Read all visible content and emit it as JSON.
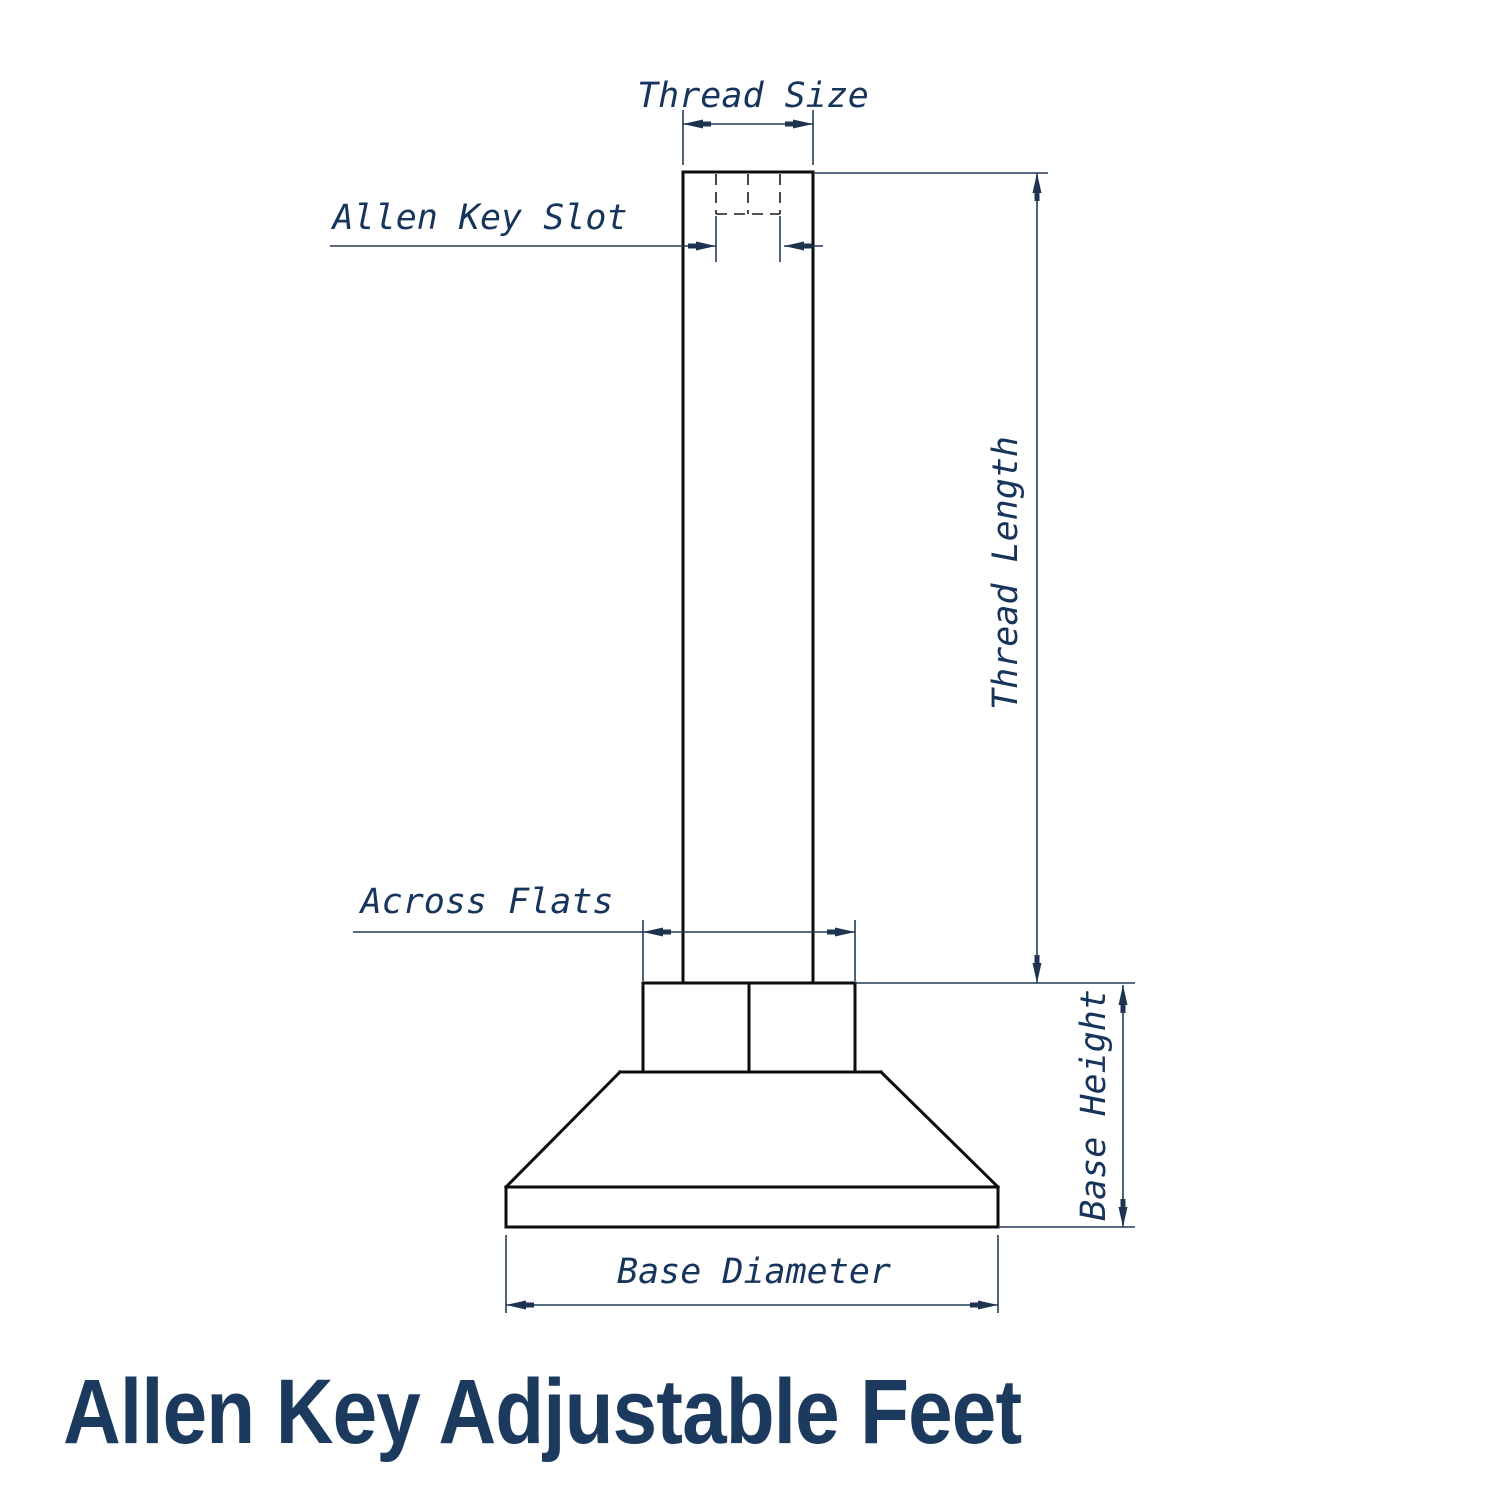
{
  "title": "Allen Key Adjustable Feet",
  "drawing": {
    "labels": {
      "thread_size": "Thread Size",
      "allen_key_slot": "Allen Key Slot",
      "thread_length": "Thread Length",
      "across_flats": "Across Flats",
      "base_height": "Base Height",
      "base_diameter": "Base Diameter"
    }
  },
  "colors": {
    "background": "#ffffff",
    "part_outline": "#0d0d0d",
    "dimension_lines": "#223a57",
    "label_text": "#17355c",
    "title_text": "#1b3a5e"
  }
}
